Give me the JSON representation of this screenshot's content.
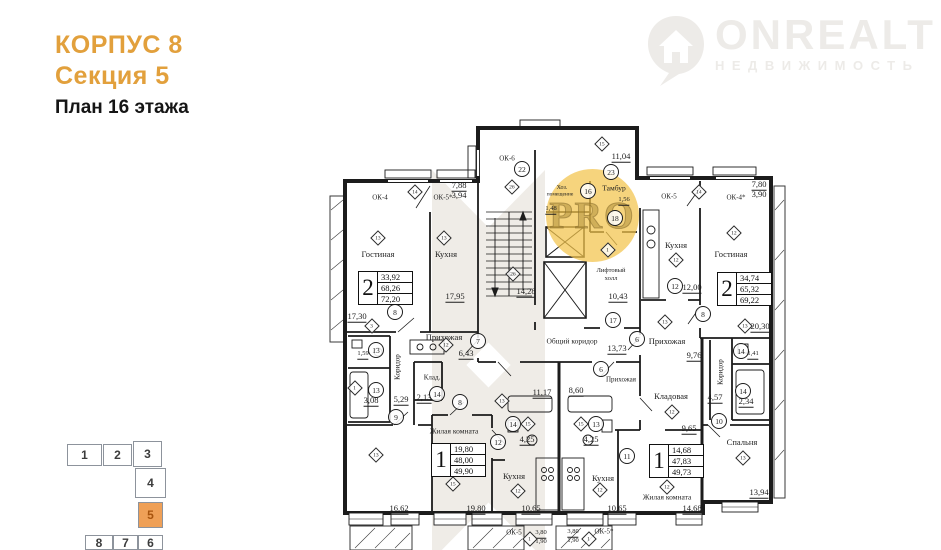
{
  "header": {
    "building": "КОРПУС 8",
    "section": "Секция 5",
    "plan": "План 16 этажа"
  },
  "logo": {
    "brand": "ONREALT",
    "subtitle": "НЕДВИЖИМОСТЬ"
  },
  "watermark": {
    "badge": "PRO"
  },
  "colors": {
    "accent_orange": "#E2A03C",
    "minimap_active_fill": "#EFA057",
    "minimap_active_text": "#A8540E",
    "minimap_outline": "#8D939C",
    "pro_circle": "#F3C44B",
    "walls": "#1C1C1C",
    "logo_gray": "#EDEBE8"
  },
  "plan": {
    "apartment_tables": [
      {
        "rooms": "2",
        "areas": [
          "33,92",
          "68,26",
          "72,20"
        ],
        "x": 358,
        "y": 271
      },
      {
        "rooms": "2",
        "areas": [
          "34,74",
          "65,32",
          "69,22"
        ],
        "x": 717,
        "y": 272
      },
      {
        "rooms": "1",
        "areas": [
          "19,80",
          "48,00",
          "49,90"
        ],
        "x": 431,
        "y": 443
      },
      {
        "rooms": "1",
        "areas": [
          "14,68",
          "47,83",
          "49,73"
        ],
        "x": 649,
        "y": 444
      }
    ],
    "labels": [
      {
        "t": "Гостиная",
        "x": 378,
        "y": 254
      },
      {
        "t": "Кухня",
        "x": 446,
        "y": 254
      },
      {
        "t": "Прихожая",
        "x": 444,
        "y": 337
      },
      {
        "t": "Хоз.",
        "x": 562,
        "y": 188,
        "s": 6
      },
      {
        "t": "помещение",
        "x": 560,
        "y": 195,
        "s": 5.5
      },
      {
        "t": "Тамбур",
        "x": 614,
        "y": 188,
        "s": 7.5
      },
      {
        "t": "Лифтовый",
        "x": 611,
        "y": 271,
        "s": 6.5
      },
      {
        "t": "холл",
        "x": 611,
        "y": 279,
        "s": 6.5
      },
      {
        "t": "Общий коридор",
        "x": 572,
        "y": 341,
        "s": 7.5
      },
      {
        "t": "Кухня",
        "x": 676,
        "y": 245
      },
      {
        "t": "Гостиная",
        "x": 731,
        "y": 254
      },
      {
        "t": "Прихожая",
        "x": 667,
        "y": 341
      },
      {
        "t": "Прихожая",
        "x": 621,
        "y": 380,
        "s": 7
      },
      {
        "t": "Кладовая",
        "x": 671,
        "y": 396
      },
      {
        "t": "Спальня",
        "x": 742,
        "y": 442
      },
      {
        "t": "Жилая комната",
        "x": 667,
        "y": 497,
        "s": 7.5
      },
      {
        "t": "Кухня",
        "x": 603,
        "y": 478
      },
      {
        "t": "Кухня",
        "x": 514,
        "y": 476
      },
      {
        "t": "Жилая комната",
        "x": 454,
        "y": 431,
        "s": 7.5
      },
      {
        "t": "Клад.",
        "x": 432,
        "y": 378,
        "s": 7
      },
      {
        "t": "Коридор",
        "x": 398,
        "y": 367,
        "r": 1,
        "s": 7
      },
      {
        "t": "Коридор",
        "x": 721,
        "y": 372,
        "r": 1,
        "s": 7
      },
      {
        "t": "ОК-4",
        "x": 380,
        "y": 198,
        "s": 7
      },
      {
        "t": "ОК-5*",
        "x": 443,
        "y": 198,
        "s": 7
      },
      {
        "t": "ОК-6",
        "x": 507,
        "y": 159,
        "s": 7
      },
      {
        "t": "ОК-5",
        "x": 669,
        "y": 197,
        "s": 7
      },
      {
        "t": "ОК-4*",
        "x": 736,
        "y": 198,
        "s": 7
      },
      {
        "t": "ОК-5",
        "x": 514,
        "y": 533,
        "s": 7
      },
      {
        "t": "ОК-5*",
        "x": 604,
        "y": 532,
        "s": 7
      },
      {
        "t": "17,30",
        "x": 357,
        "y": 317,
        "u": 1
      },
      {
        "t": "17,95",
        "x": 455,
        "y": 297,
        "u": 1
      },
      {
        "t": "14,28",
        "x": 526,
        "y": 292,
        "u": 1
      },
      {
        "t": "7,88",
        "x": 459,
        "y": 186,
        "u": 1
      },
      {
        "t": "3,94",
        "x": 459,
        "y": 195
      },
      {
        "t": "11,04",
        "x": 621,
        "y": 157,
        "u": 1
      },
      {
        "t": "1,48",
        "x": 551,
        "y": 210,
        "u": 1,
        "s": 6.5
      },
      {
        "t": "1,56",
        "x": 624,
        "y": 201,
        "u": 1,
        "s": 6.5
      },
      {
        "t": "10,43",
        "x": 618,
        "y": 297,
        "u": 1
      },
      {
        "t": "12,00",
        "x": 692,
        "y": 288,
        "u": 1
      },
      {
        "t": "7,80",
        "x": 759,
        "y": 185,
        "u": 1
      },
      {
        "t": "3,90",
        "x": 759,
        "y": 194
      },
      {
        "t": "20,30",
        "x": 760,
        "y": 327,
        "u": 1
      },
      {
        "t": "13,73",
        "x": 617,
        "y": 349,
        "u": 1
      },
      {
        "t": "9,76",
        "x": 694,
        "y": 356,
        "u": 1
      },
      {
        "t": "6,43",
        "x": 466,
        "y": 354,
        "u": 1
      },
      {
        "t": "1,59",
        "x": 363,
        "y": 355,
        "u": 1,
        "s": 6.5
      },
      {
        "t": "3,08",
        "x": 371,
        "y": 401,
        "u": 1
      },
      {
        "t": "5,29",
        "x": 401,
        "y": 400,
        "u": 1
      },
      {
        "t": "2,13",
        "x": 424,
        "y": 398,
        "u": 1
      },
      {
        "t": "11,17",
        "x": 542,
        "y": 393,
        "u": 1
      },
      {
        "t": "8,60",
        "x": 576,
        "y": 391,
        "u": 1
      },
      {
        "t": "4,25",
        "x": 527,
        "y": 440,
        "u": 1
      },
      {
        "t": "4,25",
        "x": 591,
        "y": 440,
        "u": 1
      },
      {
        "t": "4,57",
        "x": 715,
        "y": 398,
        "u": 1
      },
      {
        "t": "2,34",
        "x": 746,
        "y": 402,
        "u": 1
      },
      {
        "t": "1,41",
        "x": 753,
        "y": 355,
        "u": 1,
        "s": 6.5
      },
      {
        "t": "9,65",
        "x": 689,
        "y": 429,
        "u": 1
      },
      {
        "t": "16,62",
        "x": 399,
        "y": 509,
        "u": 1
      },
      {
        "t": "19,80",
        "x": 476,
        "y": 509,
        "u": 1
      },
      {
        "t": "10,65",
        "x": 531,
        "y": 509,
        "u": 1
      },
      {
        "t": "10,65",
        "x": 617,
        "y": 509,
        "u": 1
      },
      {
        "t": "14,68",
        "x": 692,
        "y": 509,
        "u": 1
      },
      {
        "t": "13,94",
        "x": 759,
        "y": 493,
        "u": 1
      },
      {
        "t": "3,80",
        "x": 541,
        "y": 534,
        "u": 1,
        "s": 6.5
      },
      {
        "t": "1,90",
        "x": 541,
        "y": 542,
        "s": 6.5
      },
      {
        "t": "3,80",
        "x": 573,
        "y": 533,
        "u": 1,
        "s": 6.5
      },
      {
        "t": "1,90",
        "x": 573,
        "y": 541,
        "s": 6.5
      }
    ],
    "door_numbers": [
      {
        "n": "22",
        "x": 522,
        "y": 169
      },
      {
        "n": "23",
        "x": 611,
        "y": 172
      },
      {
        "n": "16",
        "x": 588,
        "y": 191
      },
      {
        "n": "18",
        "x": 615,
        "y": 218
      },
      {
        "n": "17",
        "x": 613,
        "y": 320
      },
      {
        "n": "8",
        "x": 395,
        "y": 312
      },
      {
        "n": "13",
        "x": 376,
        "y": 350
      },
      {
        "n": "13",
        "x": 376,
        "y": 390
      },
      {
        "n": "9",
        "x": 396,
        "y": 417
      },
      {
        "n": "14",
        "x": 437,
        "y": 394
      },
      {
        "n": "8",
        "x": 460,
        "y": 402
      },
      {
        "n": "7",
        "x": 478,
        "y": 341
      },
      {
        "n": "12",
        "x": 498,
        "y": 442
      },
      {
        "n": "14",
        "x": 513,
        "y": 424
      },
      {
        "n": "13",
        "x": 596,
        "y": 424
      },
      {
        "n": "6",
        "x": 637,
        "y": 339
      },
      {
        "n": "6",
        "x": 601,
        "y": 369
      },
      {
        "n": "11",
        "x": 627,
        "y": 456
      },
      {
        "n": "12",
        "x": 675,
        "y": 286
      },
      {
        "n": "8",
        "x": 703,
        "y": 314
      },
      {
        "n": "14",
        "x": 741,
        "y": 351
      },
      {
        "n": "14",
        "x": 743,
        "y": 391
      },
      {
        "n": "10",
        "x": 719,
        "y": 421
      }
    ],
    "vent_marks": [
      {
        "n": "14",
        "x": 415,
        "y": 192
      },
      {
        "n": "13",
        "x": 378,
        "y": 238
      },
      {
        "n": "13",
        "x": 444,
        "y": 238
      },
      {
        "n": "26",
        "x": 512,
        "y": 187
      },
      {
        "n": "26",
        "x": 513,
        "y": 274
      },
      {
        "n": "15",
        "x": 602,
        "y": 144
      },
      {
        "n": "1",
        "x": 608,
        "y": 250
      },
      {
        "n": "3",
        "x": 372,
        "y": 326
      },
      {
        "n": "1",
        "x": 355,
        "y": 388
      },
      {
        "n": "14",
        "x": 699,
        "y": 192
      },
      {
        "n": "12",
        "x": 734,
        "y": 233
      },
      {
        "n": "12",
        "x": 676,
        "y": 260
      },
      {
        "n": "13",
        "x": 665,
        "y": 322
      },
      {
        "n": "13",
        "x": 745,
        "y": 326
      },
      {
        "n": "12",
        "x": 672,
        "y": 412
      },
      {
        "n": "13",
        "x": 743,
        "y": 458
      },
      {
        "n": "12",
        "x": 667,
        "y": 487
      },
      {
        "n": "12",
        "x": 600,
        "y": 490
      },
      {
        "n": "12",
        "x": 518,
        "y": 491
      },
      {
        "n": "15",
        "x": 453,
        "y": 484
      },
      {
        "n": "13",
        "x": 376,
        "y": 455
      },
      {
        "n": "12",
        "x": 446,
        "y": 345
      },
      {
        "n": "13",
        "x": 502,
        "y": 401
      },
      {
        "n": "15",
        "x": 528,
        "y": 424
      },
      {
        "n": "15",
        "x": 581,
        "y": 424
      },
      {
        "n": "1",
        "x": 530,
        "y": 539
      },
      {
        "n": "1",
        "x": 589,
        "y": 539
      }
    ]
  },
  "minimap": {
    "active": "5",
    "sections": [
      {
        "n": "1",
        "x": 67,
        "y": 444,
        "w": 35,
        "h": 22
      },
      {
        "n": "2",
        "x": 103,
        "y": 444,
        "w": 29,
        "h": 22
      },
      {
        "n": "3",
        "x": 133,
        "y": 441,
        "w": 29,
        "h": 26
      },
      {
        "n": "4",
        "x": 135,
        "y": 468,
        "w": 31,
        "h": 30
      },
      {
        "n": "5",
        "x": 138,
        "y": 502,
        "w": 25,
        "h": 26,
        "active": true
      },
      {
        "n": "8",
        "x": 85,
        "y": 535,
        "w": 28,
        "h": 15
      },
      {
        "n": "7",
        "x": 113,
        "y": 535,
        "w": 25,
        "h": 15
      },
      {
        "n": "6",
        "x": 138,
        "y": 535,
        "w": 25,
        "h": 15
      }
    ]
  }
}
